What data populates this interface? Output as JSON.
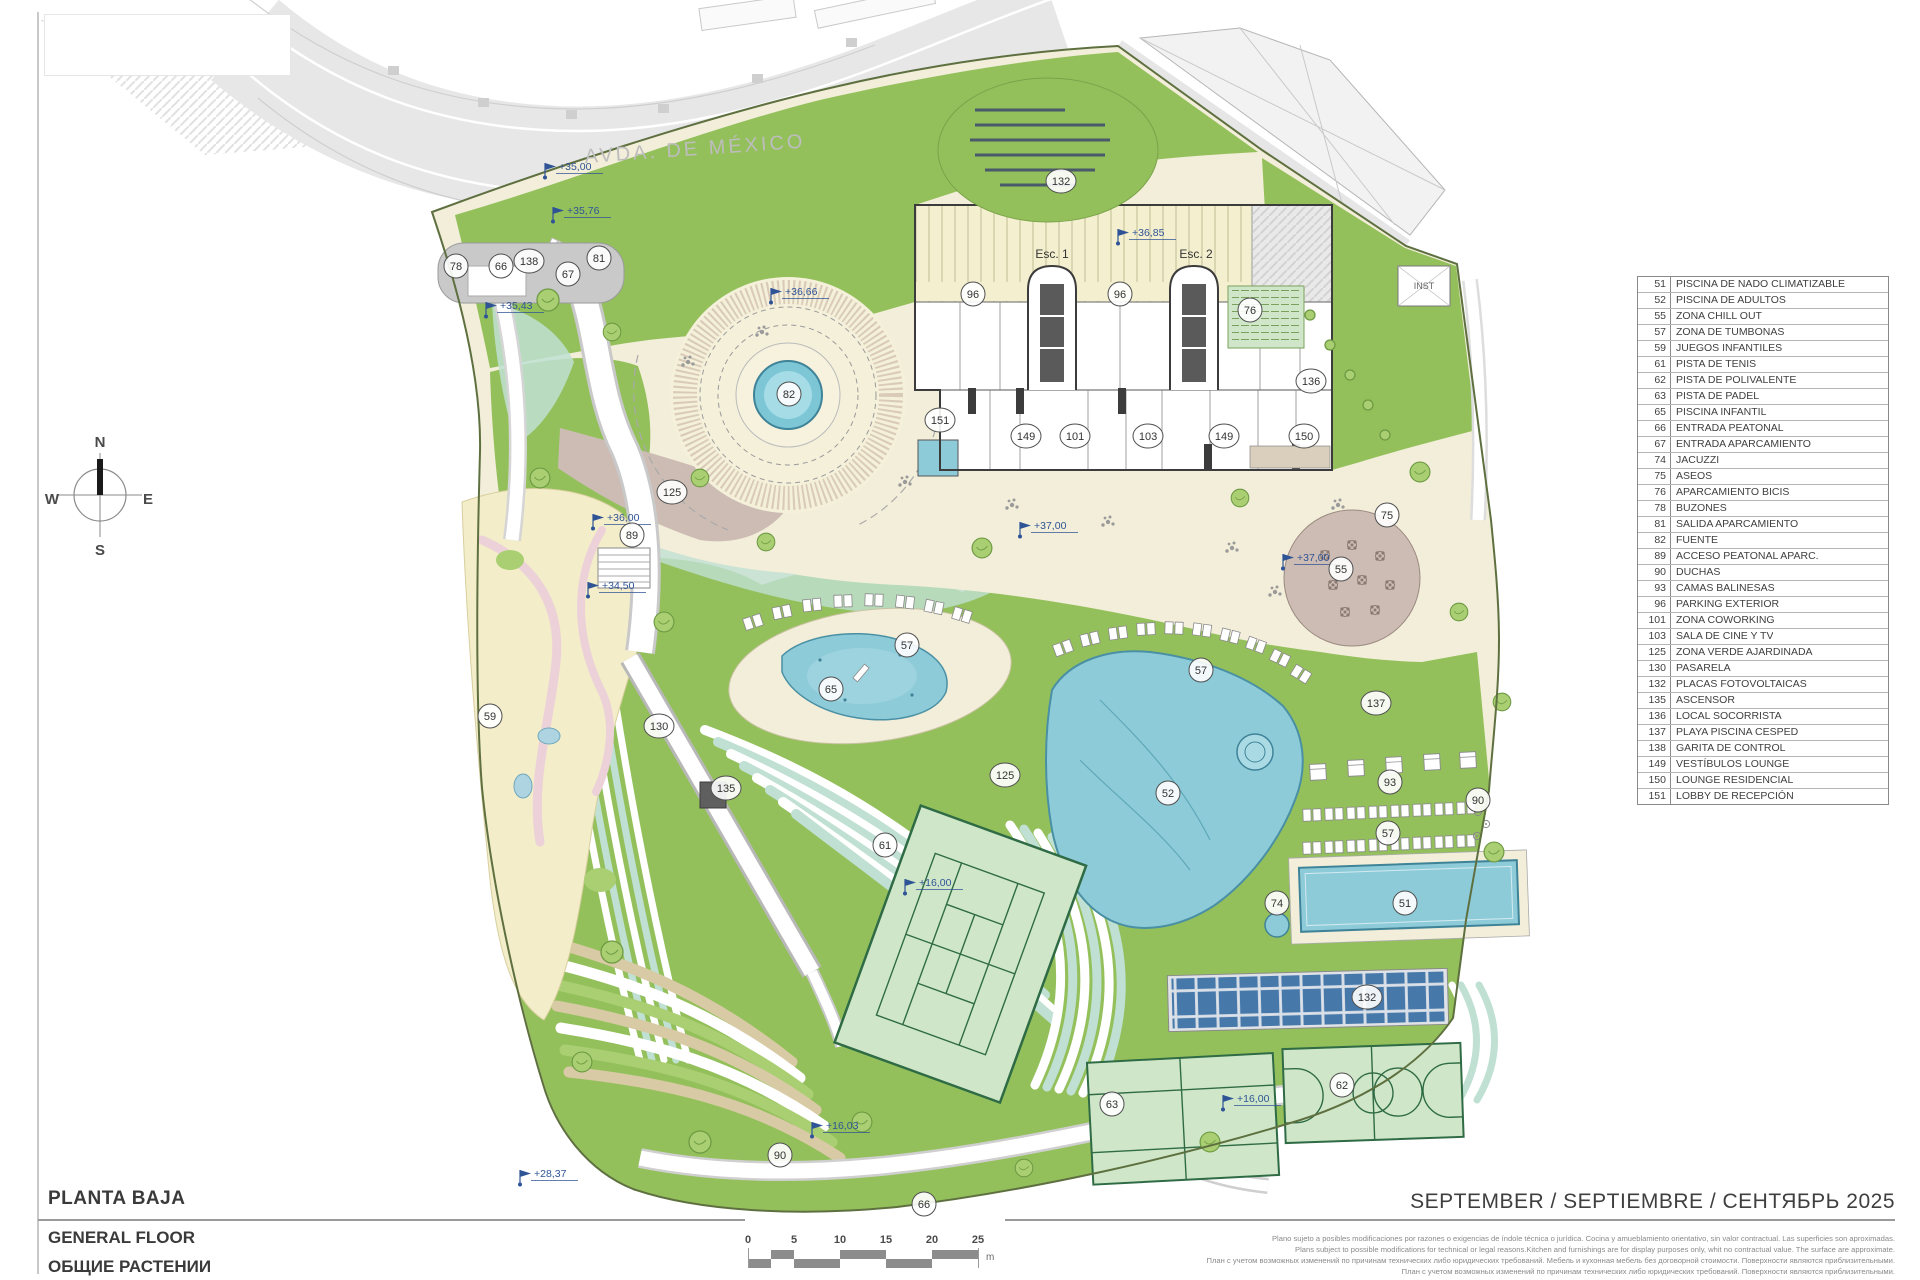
{
  "colors": {
    "site_green": "#94c05c",
    "light_green": "#a9cf72",
    "cream": "#f2eed9",
    "parking_cream": "#f3efcf",
    "sand": "#f3edc9",
    "mint": "#bfe0d2",
    "pool_blue": "#8ecbd9",
    "pool_light": "#aadbe4",
    "pool_line": "#3f8398",
    "mauve": "#cdbcb4",
    "tan": "#d8caa4",
    "court_green": "#cfe7c8",
    "court_line": "#2f6b45",
    "solar_blue": "#4678aa",
    "road_gray": "#e7e7e7",
    "canopy_gray": "#c9c9c9",
    "wall_dark": "#3c3c3c",
    "level_blue": "#2f5496",
    "boundary": "#5f7040"
  },
  "street": {
    "label": "AVDA. DE MÉXICO"
  },
  "compass": {
    "n": "N",
    "e": "E",
    "s": "S",
    "w": "W"
  },
  "building": {
    "esc1": "Esc. 1",
    "esc2": "Esc. 2",
    "inst": "INST"
  },
  "legend": {
    "items": [
      {
        "num": "51",
        "label": "PISCINA DE NADO CLIMATIZABLE"
      },
      {
        "num": "52",
        "label": "PISCINA DE ADULTOS"
      },
      {
        "num": "55",
        "label": "ZONA CHILL OUT"
      },
      {
        "num": "57",
        "label": "ZONA DE TUMBONAS"
      },
      {
        "num": "59",
        "label": "JUEGOS INFANTILES"
      },
      {
        "num": "61",
        "label": "PISTA DE TENIS"
      },
      {
        "num": "62",
        "label": "PISTA DE POLIVALENTE"
      },
      {
        "num": "63",
        "label": "PISTA DE PADEL"
      },
      {
        "num": "65",
        "label": "PISCINA INFANTIL"
      },
      {
        "num": "66",
        "label": "ENTRADA PEATONAL"
      },
      {
        "num": "67",
        "label": "ENTRADA APARCAMIENTO"
      },
      {
        "num": "74",
        "label": "JACUZZI"
      },
      {
        "num": "75",
        "label": "ASEOS"
      },
      {
        "num": "76",
        "label": "APARCAMIENTO BICIS"
      },
      {
        "num": "78",
        "label": "BUZONES"
      },
      {
        "num": "81",
        "label": "SALIDA APARCAMIENTO"
      },
      {
        "num": "82",
        "label": "FUENTE"
      },
      {
        "num": "89",
        "label": "ACCESO PEATONAL APARC."
      },
      {
        "num": "90",
        "label": "DUCHAS"
      },
      {
        "num": "93",
        "label": "CAMAS BALINESAS"
      },
      {
        "num": "96",
        "label": "PARKING EXTERIOR"
      },
      {
        "num": "101",
        "label": "ZONA COWORKING"
      },
      {
        "num": "103",
        "label": "SALA DE CINE Y TV"
      },
      {
        "num": "125",
        "label": "ZONA VERDE AJARDINADA"
      },
      {
        "num": "130",
        "label": "PASARELA"
      },
      {
        "num": "132",
        "label": "PLACAS FOTOVOLTAICAS"
      },
      {
        "num": "135",
        "label": "ASCENSOR"
      },
      {
        "num": "136",
        "label": "LOCAL SOCORRISTA"
      },
      {
        "num": "137",
        "label": "PLAYA PISCINA CESPED"
      },
      {
        "num": "138",
        "label": "GARITA DE CONTROL"
      },
      {
        "num": "149",
        "label": "VESTÍBULOS LOUNGE"
      },
      {
        "num": "150",
        "label": "LOUNGE RESIDENCIAL"
      },
      {
        "num": "151",
        "label": "LOBBY DE RECEPCIÓN"
      }
    ]
  },
  "markers": [
    {
      "num": "78",
      "x": 456,
      "y": 266
    },
    {
      "num": "66",
      "x": 501,
      "y": 266
    },
    {
      "num": "138",
      "x": 529,
      "y": 261
    },
    {
      "num": "67",
      "x": 568,
      "y": 274
    },
    {
      "num": "81",
      "x": 599,
      "y": 258
    },
    {
      "num": "132",
      "x": 1061,
      "y": 181
    },
    {
      "num": "96",
      "x": 973,
      "y": 294
    },
    {
      "num": "96",
      "x": 1120,
      "y": 294
    },
    {
      "num": "76",
      "x": 1250,
      "y": 310
    },
    {
      "num": "136",
      "x": 1311,
      "y": 381
    },
    {
      "num": "82",
      "x": 789,
      "y": 394
    },
    {
      "num": "151",
      "x": 940,
      "y": 420
    },
    {
      "num": "149",
      "x": 1026,
      "y": 436
    },
    {
      "num": "101",
      "x": 1075,
      "y": 436
    },
    {
      "num": "103",
      "x": 1148,
      "y": 436
    },
    {
      "num": "149",
      "x": 1224,
      "y": 436
    },
    {
      "num": "150",
      "x": 1304,
      "y": 436
    },
    {
      "num": "125",
      "x": 672,
      "y": 492
    },
    {
      "num": "89",
      "x": 632,
      "y": 535
    },
    {
      "num": "75",
      "x": 1387,
      "y": 515
    },
    {
      "num": "55",
      "x": 1341,
      "y": 569
    },
    {
      "num": "57",
      "x": 907,
      "y": 645
    },
    {
      "num": "65",
      "x": 831,
      "y": 689
    },
    {
      "num": "130",
      "x": 659,
      "y": 726
    },
    {
      "num": "135",
      "x": 726,
      "y": 788
    },
    {
      "num": "59",
      "x": 490,
      "y": 716
    },
    {
      "num": "57",
      "x": 1201,
      "y": 670
    },
    {
      "num": "137",
      "x": 1376,
      "y": 703
    },
    {
      "num": "125",
      "x": 1005,
      "y": 775
    },
    {
      "num": "52",
      "x": 1168,
      "y": 793
    },
    {
      "num": "93",
      "x": 1390,
      "y": 782
    },
    {
      "num": "90",
      "x": 1478,
      "y": 800
    },
    {
      "num": "57",
      "x": 1388,
      "y": 833
    },
    {
      "num": "61",
      "x": 885,
      "y": 845
    },
    {
      "num": "74",
      "x": 1277,
      "y": 903
    },
    {
      "num": "51",
      "x": 1405,
      "y": 903
    },
    {
      "num": "132",
      "x": 1367,
      "y": 997
    },
    {
      "num": "63",
      "x": 1112,
      "y": 1104
    },
    {
      "num": "62",
      "x": 1342,
      "y": 1085
    },
    {
      "num": "90",
      "x": 780,
      "y": 1155
    },
    {
      "num": "66",
      "x": 924,
      "y": 1204
    }
  ],
  "levels": [
    {
      "text": "+35,00",
      "x": 545,
      "y": 176
    },
    {
      "text": "+35,76",
      "x": 553,
      "y": 220
    },
    {
      "text": "+35,43",
      "x": 486,
      "y": 315
    },
    {
      "text": "+36,66",
      "x": 771,
      "y": 301
    },
    {
      "text": "+36,85",
      "x": 1118,
      "y": 242
    },
    {
      "text": "+36,00",
      "x": 593,
      "y": 527
    },
    {
      "text": "+34,50",
      "x": 588,
      "y": 595
    },
    {
      "text": "+37,00",
      "x": 1020,
      "y": 535
    },
    {
      "text": "+37,00",
      "x": 1283,
      "y": 567
    },
    {
      "text": "+16,00",
      "x": 905,
      "y": 892
    },
    {
      "text": "+16,00",
      "x": 1223,
      "y": 1108
    },
    {
      "text": "+16,03",
      "x": 812,
      "y": 1135
    },
    {
      "text": "+28,37",
      "x": 520,
      "y": 1183
    }
  ],
  "scale_bar": {
    "ticks": [
      "0",
      "5",
      "10",
      "15",
      "20",
      "25"
    ],
    "unit": "m"
  },
  "title_block": {
    "title_es": "PLANTA BAJA",
    "title_en": "GENERAL FLOOR",
    "title_ru": "ОБЩИЕ РАСТЕНИИ"
  },
  "footer": {
    "date_line": "SEPTEMBER / SEPTIEMBRE / СЕНТЯБРЬ 2025",
    "disclaimer": [
      "Plano sujeto a posibles modificaciones por razones o exigencias de índole técnica o jurídica. Cocina y amueblamiento orientativo, sin valor contractual. Las superficies son aproximadas.",
      "Plans subject to possible modifications for technical or legal reasons.Kitchen and furnishings are for display purposes only, whit no contractual value. The surface are approximate.",
      "План с учетом возможных изменений по причинам технических либо юридических требований. Мебель и кухонная мебель без договорной стоимости. Поверхности являются приблизительными.",
      "План с учетом возможных изменений по причинам технических либо юридических требований. Поверхности являются приблизительными."
    ]
  }
}
